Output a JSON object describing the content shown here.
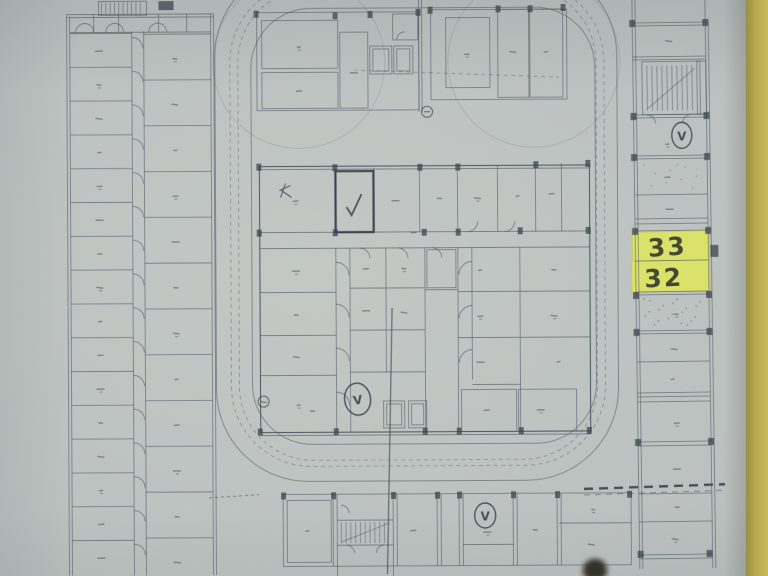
{
  "scene": {
    "type": "scanned floor plan photograph",
    "paper_color": "#bdc3c0",
    "desk_color": "#c0b254",
    "ink_color": "#4d5662",
    "highlight_color": "#dfe55f"
  },
  "annotations": {
    "highlighted_units": {
      "top": "33",
      "bottom": "32"
    }
  },
  "symbols": {
    "vent_label": "V"
  }
}
